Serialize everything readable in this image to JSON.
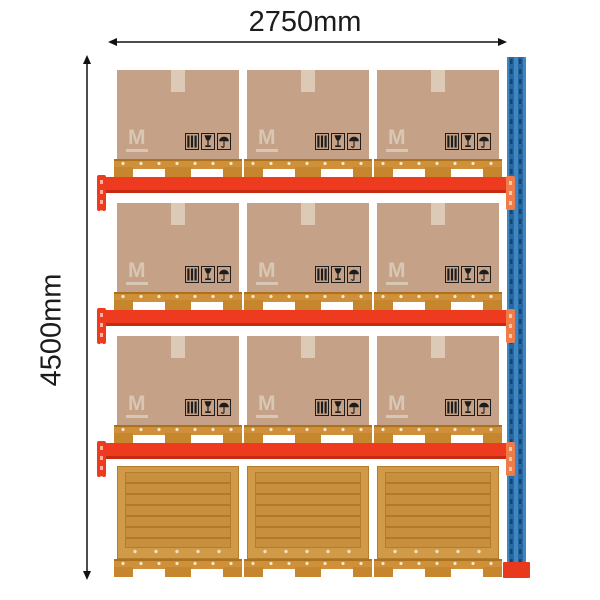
{
  "diagram": {
    "title": "pallet-racking-bay-loaded",
    "width_dimension": {
      "label": "2750mm"
    },
    "height_dimension": {
      "label": "4500mm"
    }
  },
  "box": {
    "logo_text": "M",
    "symbols": [
      "stacking-bars",
      "fragile-glass",
      "keep-dry-umbrella"
    ]
  },
  "rack": {
    "beam_levels": 3,
    "boxes_per_beam_level": 3,
    "crates_on_floor": 3,
    "pallets_total": 12,
    "colors": {
      "beam_red": "#ee3a1f",
      "beam_shadow": "#c62b11",
      "beam_connector_red": "#ee3a1f",
      "beam_connector_orange": "#ef7b4a",
      "upright_blue": "#3f87c2",
      "upright_rail_blue": "#2767a2",
      "upright_slot_blue": "#16446b",
      "upright_foot_red": "#e8391c",
      "box_tan": "#c5a287",
      "box_tape": "#dccab7",
      "box_logo": "#d8c7b5",
      "pallet_deck": "#d0903a",
      "pallet_block": "#c6862e",
      "crate_frame": "#d09a48",
      "crate_panel": "#c88f3e",
      "crate_line": "#b2782c",
      "dimension_line": "#4d4d4d",
      "text": "#1c1c1c",
      "background": "#ffffff"
    }
  }
}
